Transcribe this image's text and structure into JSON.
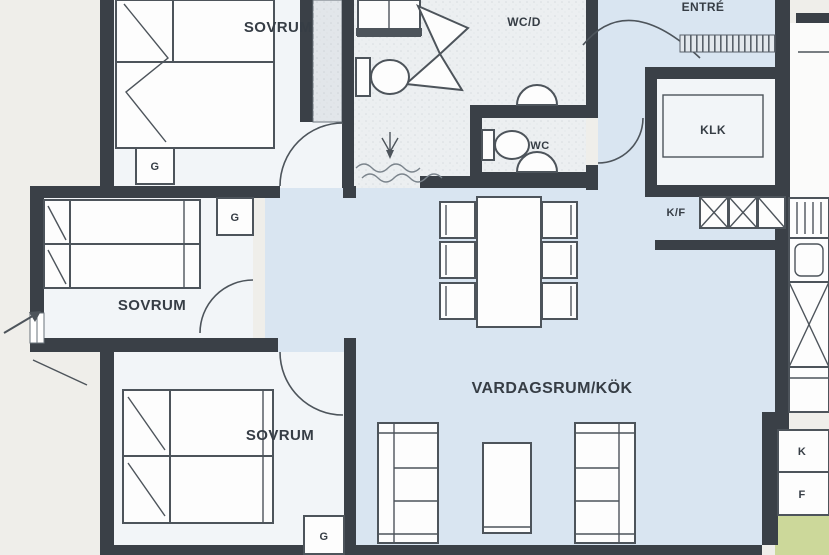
{
  "plan_title": "apartment-floor-plan",
  "labels": {
    "bedroom_top": "SOVRUM",
    "bedroom_middle": "SOVRUM",
    "bedroom_bottom": "SOVRUM",
    "bathroom": "WC/D",
    "wc": "WC",
    "entrance": "ENTRÉ",
    "walkin_closet": "KLK",
    "fridge_freezer_unit": "K/F",
    "living_kitchen": "VARDAGSRUM/KÖK",
    "fridge": "K",
    "freezer": "F",
    "wardrobe": "G"
  },
  "colors": {
    "wall": "#3a4047",
    "room_floor": "#f2f5f8",
    "living_floor": "#d9e5f1",
    "bath_floor": "#eceff1",
    "outside": "#efeeea",
    "lawn": "#ccd89a",
    "furniture_line": "#4d545b",
    "label_ink": "#363d45"
  }
}
